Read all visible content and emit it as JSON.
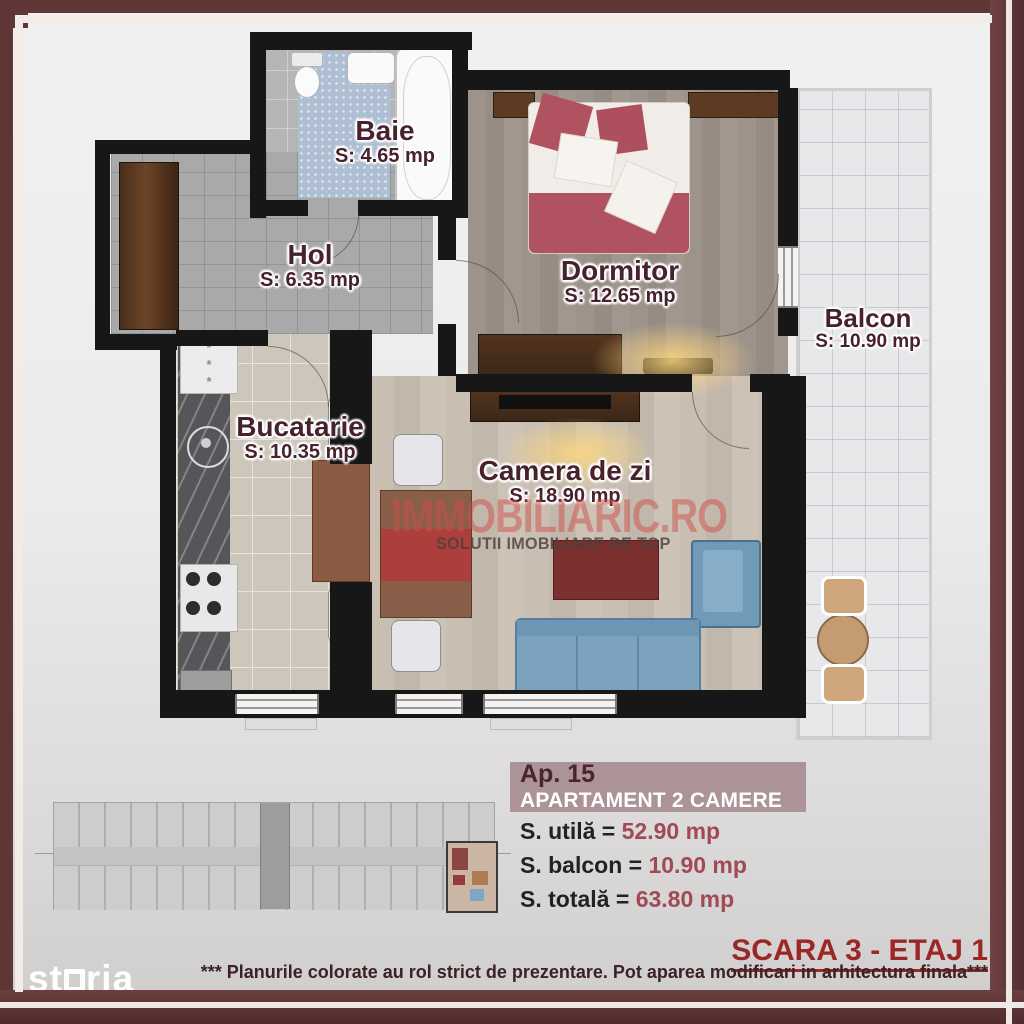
{
  "rooms": [
    {
      "name": "Baie",
      "area": "S: 4.65 mp"
    },
    {
      "name": "Hol",
      "area": "S: 6.35 mp"
    },
    {
      "name": "Dormitor",
      "area": "S: 12.65 mp"
    },
    {
      "name": "Balcon",
      "area": "S: 10.90 mp"
    },
    {
      "name": "Bucatarie",
      "area": "S: 10.35 mp"
    },
    {
      "name": "Camera de zi",
      "area": "S: 18.90 mp"
    }
  ],
  "watermark": {
    "brand": "IMMOBILIARIC.RO",
    "tagline": "SOLUTII IMOBILIARE DE TOP"
  },
  "info": {
    "apartment_no": "Ap. 15",
    "apartment_type": "APARTAMENT 2 CAMERE",
    "areas": [
      {
        "label": "S. utilă = ",
        "value": "52.90 mp"
      },
      {
        "label": "S. balcon = ",
        "value": "10.90 mp"
      },
      {
        "label": "S. totală = ",
        "value": "63.80 mp"
      }
    ]
  },
  "footer": {
    "scara": "SCARA 3 - ETAJ 1",
    "disclaimer": "*** Planurile colorate au rol strict de prezentare. Pot aparea modificari in arhitectura finala***",
    "logo_prefix": "st",
    "logo_suffix": "ria"
  },
  "colors": {
    "frame_maroon": "#5f3536",
    "scara_red": "#9c2727",
    "value_red": "#a04a55",
    "band_rose": "#ab9398",
    "label_maroon": "#47222d"
  }
}
